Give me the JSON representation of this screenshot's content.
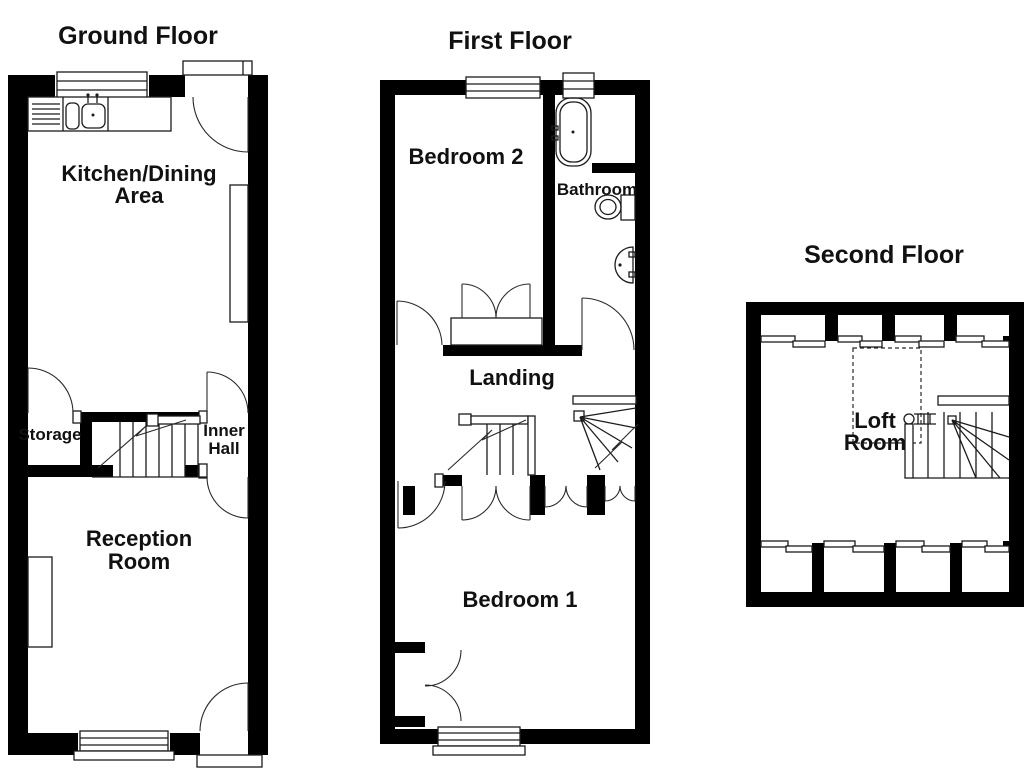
{
  "page": {
    "background": "#ffffff",
    "wall_color": "#000000",
    "line_color": "#1b1b1b"
  },
  "floors": {
    "ground": {
      "title": "Ground Floor",
      "rooms": {
        "kitchen_dining": {
          "line1": "Kitchen/Dining",
          "line2": "Area"
        },
        "storage": {
          "label": "Storage"
        },
        "inner_hall": {
          "line1": "Inner",
          "line2": "Hall"
        },
        "reception": {
          "line1": "Reception",
          "line2": "Room"
        }
      }
    },
    "first": {
      "title": "First Floor",
      "rooms": {
        "bedroom2": {
          "label": "Bedroom 2"
        },
        "bathroom": {
          "label": "Bathroom"
        },
        "landing": {
          "label": "Landing"
        },
        "bedroom1": {
          "label": "Bedroom 1"
        }
      }
    },
    "second": {
      "title": "Second Floor",
      "rooms": {
        "loft": {
          "line1": "Loft",
          "line2": "Room"
        }
      }
    }
  },
  "fixtures": {
    "kitchen_sink": "kitchen sink and drainer",
    "bathtub": "bathtub",
    "toilet": "toilet",
    "washbasin": "washbasin",
    "ground_staircase": "staircase",
    "landing_staircase_down": "staircase down",
    "landing_staircase_up": "winder staircase up",
    "loft_staircase": "winder staircase",
    "loft_void": "reduced headroom dashed outline"
  }
}
